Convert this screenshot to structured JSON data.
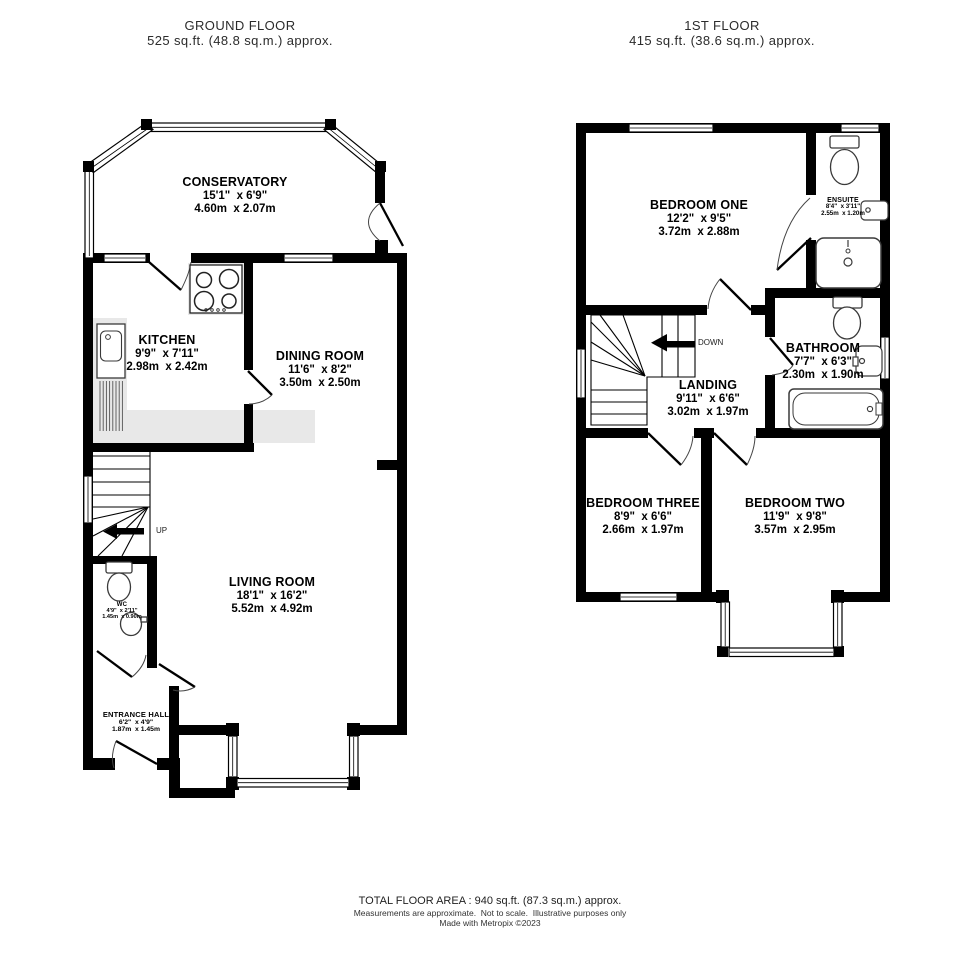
{
  "ground_floor": {
    "title": "GROUND FLOOR",
    "area": "525 sq.ft. (48.8 sq.m.) approx.",
    "stairs_label": "UP",
    "rooms": {
      "conservatory": {
        "name": "CONSERVATORY",
        "imperial": "15'1\"  x 6'9\"",
        "metric": "4.60m  x 2.07m"
      },
      "kitchen": {
        "name": "KITCHEN",
        "imperial": "9'9\"  x 7'11\"",
        "metric": "2.98m  x 2.42m"
      },
      "dining_room": {
        "name": "DINING ROOM",
        "imperial": "11'6\"  x 8'2\"",
        "metric": "3.50m  x 2.50m"
      },
      "living_room": {
        "name": "LIVING ROOM",
        "imperial": "18'1\"  x 16'2\"",
        "metric": "5.52m  x 4.92m"
      },
      "wc": {
        "name": "WC",
        "imperial": "4'9\"  x 2'11\"",
        "metric": "1.45m  x 0.90m"
      },
      "entrance_hall": {
        "name": "ENTRANCE HALL",
        "imperial": "6'2\"  x 4'9\"",
        "metric": "1.87m  x 1.45m"
      }
    }
  },
  "first_floor": {
    "title": "1ST FLOOR",
    "area": "415 sq.ft. (38.6 sq.m.) approx.",
    "stairs_label": "DOWN",
    "rooms": {
      "bedroom_one": {
        "name": "BEDROOM ONE",
        "imperial": "12'2\"  x 9'5\"",
        "metric": "3.72m  x 2.88m"
      },
      "ensuite": {
        "name": "ENSUITE",
        "imperial": "8'4\"  x 3'11\"",
        "metric": "2.55m  x 1.20m"
      },
      "bathroom": {
        "name": "BATHROOM",
        "imperial": "7'7\"  x 6'3\"",
        "metric": "2.30m  x 1.90m"
      },
      "landing": {
        "name": "LANDING",
        "imperial": "9'11\"  x 6'6\"",
        "metric": "3.02m  x 1.97m"
      },
      "bedroom_three": {
        "name": "BEDROOM THREE",
        "imperial": "8'9\"  x 6'6\"",
        "metric": "2.66m  x 1.97m"
      },
      "bedroom_two": {
        "name": "BEDROOM TWO",
        "imperial": "11'9\"  x 9'8\"",
        "metric": "3.57m  x 2.95m"
      }
    }
  },
  "footer": {
    "total_area": "TOTAL FLOOR AREA : 940 sq.ft. (87.3 sq.m.) approx.",
    "disclaimer": "Measurements are approximate.  Not to scale.  Illustrative purposes only",
    "credit": "Made with Metropix ©2023"
  },
  "colors": {
    "wall": "#000000",
    "counter": "#e8e8e8",
    "fixture_outline": "#3a3a3a"
  }
}
